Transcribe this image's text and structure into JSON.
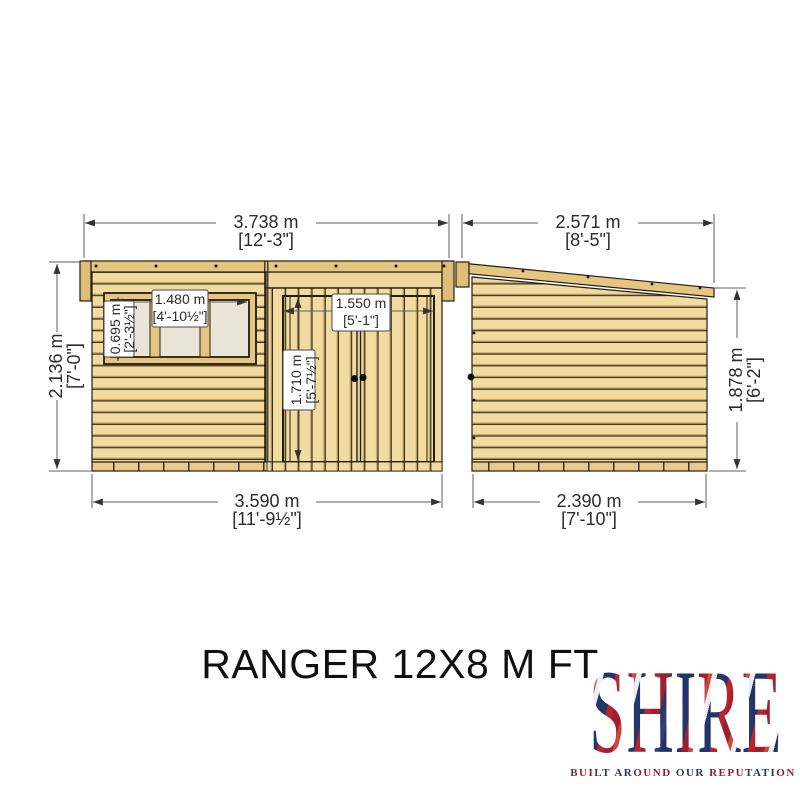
{
  "title": "RANGER 12X8 M FT",
  "brand": {
    "name": "SHIRE",
    "tagline": "BUILT AROUND OUR REPUTATION"
  },
  "colors": {
    "wood_light": "#F1DBA1",
    "wood_trim": "#E6C581",
    "wood_dark_trim": "#DFBC77",
    "window_pane": "#EAE5D6",
    "outline": "#241d0f",
    "dimension_text": "#2b2b2b",
    "background": "#ffffff"
  },
  "front_view": {
    "overall_width": {
      "metric": "3.738 m",
      "imperial": "[12'-3\"]"
    },
    "wall_height": {
      "metric": "2.136 m",
      "imperial": "[7'-0\"]"
    },
    "base_width": {
      "metric": "3.590 m",
      "imperial": "[11'-9½\"]"
    },
    "window": {
      "width": {
        "metric": "1.480 m",
        "imperial": "[4'-10½\"]"
      },
      "height": {
        "metric": "0.695 m",
        "imperial": "[2'-3½\"]"
      }
    },
    "door": {
      "width": {
        "metric": "1.550 m",
        "imperial": "[5'-1\"]"
      },
      "height": {
        "metric": "1.710 m",
        "imperial": "[5'-7½\"]"
      }
    }
  },
  "side_view": {
    "overall_width": {
      "metric": "2.571 m",
      "imperial": "[8'-5\"]"
    },
    "eaves_height": {
      "metric": "1.878 m",
      "imperial": "[6'-2\"]"
    },
    "base_width": {
      "metric": "2.390 m",
      "imperial": "[7'-10\"]"
    }
  }
}
